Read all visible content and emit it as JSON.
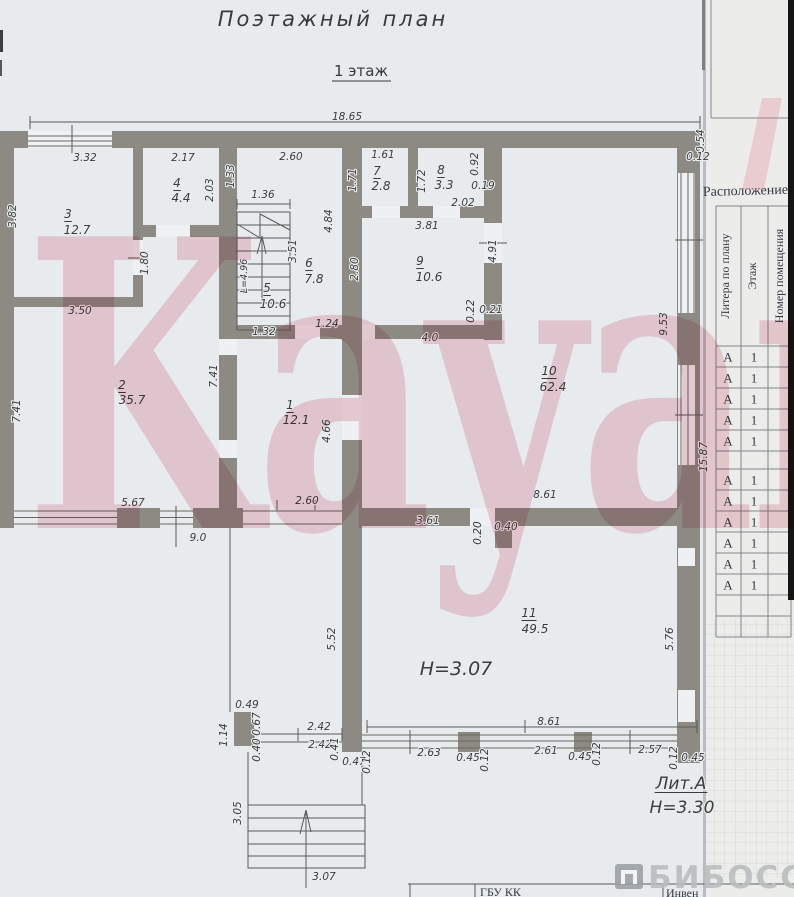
{
  "page": {
    "title": "Поэтажный план",
    "floor": "1 этаж"
  },
  "watermark": {
    "text": "Kayan",
    "brand": "БИБОСС"
  },
  "plan": {
    "rooms": [
      {
        "number": "1",
        "area_m2": "12.1"
      },
      {
        "number": "2",
        "area_m2": "35.7"
      },
      {
        "number": "3",
        "area_m2": "12.7"
      },
      {
        "number": "4",
        "area_m2": "4.4"
      },
      {
        "number": "5",
        "area_m2": "10.6"
      },
      {
        "number": "6",
        "area_m2": "7.8"
      },
      {
        "number": "7",
        "area_m2": "2.8"
      },
      {
        "number": "8",
        "area_m2": "3.3"
      },
      {
        "number": "9",
        "area_m2": "10.6"
      },
      {
        "number": "10",
        "area_m2": "62.4"
      },
      {
        "number": "11",
        "area_m2": "49.5"
      }
    ],
    "height_note_room11": "Н=3.07",
    "litera_note": "Лит.А",
    "height_note_building": "Н=3.30",
    "labels": [
      {
        "t": "18.65",
        "x": 347,
        "y": 120
      },
      {
        "t": "3.32",
        "x": 85,
        "y": 161
      },
      {
        "t": "2.17",
        "x": 183,
        "y": 161
      },
      {
        "t": "2.60",
        "x": 291,
        "y": 160
      },
      {
        "t": "1.61",
        "x": 383,
        "y": 158
      },
      {
        "t": "0.54",
        "x": 704,
        "y": 141,
        "r": -90
      },
      {
        "t": "0.12",
        "x": 698,
        "y": 160
      },
      {
        "t": "1.33",
        "x": 234,
        "y": 176,
        "r": -90
      },
      {
        "t": "1.71",
        "x": 356,
        "y": 180,
        "r": -90
      },
      {
        "t": "1.72",
        "x": 425,
        "y": 181,
        "r": -90
      },
      {
        "t": "0.92",
        "x": 478,
        "y": 164,
        "r": -90
      },
      {
        "t": "4",
        "x": 177,
        "y": 187,
        "s": 12,
        "u": true,
        "n": "room-number"
      },
      {
        "t": "4.4",
        "x": 181,
        "y": 202,
        "s": 12,
        "n": "room-area"
      },
      {
        "t": "2.03",
        "x": 213,
        "y": 190,
        "r": -90
      },
      {
        "t": "7",
        "x": 377,
        "y": 175,
        "s": 12,
        "u": true,
        "n": "room-number"
      },
      {
        "t": "2.8",
        "x": 381,
        "y": 190,
        "s": 12,
        "n": "room-area"
      },
      {
        "t": "8",
        "x": 441,
        "y": 174,
        "s": 12,
        "u": true,
        "n": "room-number"
      },
      {
        "t": "3.3",
        "x": 444,
        "y": 189,
        "s": 12,
        "n": "room-area"
      },
      {
        "t": "0.19",
        "x": 483,
        "y": 189
      },
      {
        "t": "2.02",
        "x": 463,
        "y": 206
      },
      {
        "t": "3",
        "x": 68,
        "y": 218,
        "s": 12,
        "u": true,
        "n": "room-number"
      },
      {
        "t": "12.7",
        "x": 77,
        "y": 234,
        "s": 12,
        "n": "room-area"
      },
      {
        "t": "3.82",
        "x": 16,
        "y": 216,
        "r": -90
      },
      {
        "t": "1.36",
        "x": 263,
        "y": 198
      },
      {
        "t": "4.84",
        "x": 332,
        "y": 221,
        "r": -90
      },
      {
        "t": "3.51",
        "x": 296,
        "y": 251,
        "r": -90
      },
      {
        "t": "3.81",
        "x": 427,
        "y": 229
      },
      {
        "t": "L=4.96",
        "x": 247,
        "y": 276,
        "r": -90,
        "s": 9.5
      },
      {
        "t": "6",
        "x": 309,
        "y": 267,
        "s": 12,
        "u": true,
        "n": "room-number"
      },
      {
        "t": "7.8",
        "x": 314,
        "y": 283,
        "s": 12,
        "n": "room-area"
      },
      {
        "t": "9",
        "x": 420,
        "y": 265,
        "s": 12,
        "u": true,
        "n": "room-number"
      },
      {
        "t": "10.6",
        "x": 429,
        "y": 281,
        "s": 12,
        "n": "room-area"
      },
      {
        "t": "2.80",
        "x": 358,
        "y": 269,
        "r": -90
      },
      {
        "t": "4.91",
        "x": 496,
        "y": 251,
        "r": -90
      },
      {
        "t": "1.80",
        "x": 148,
        "y": 263,
        "r": -90
      },
      {
        "t": "3.50",
        "x": 80,
        "y": 314
      },
      {
        "t": "5",
        "x": 267,
        "y": 292,
        "s": 12,
        "u": true,
        "n": "room-number"
      },
      {
        "t": "10.6",
        "x": 273,
        "y": 308,
        "s": 12,
        "n": "room-area"
      },
      {
        "t": "1.32",
        "x": 264,
        "y": 335
      },
      {
        "t": "1.24",
        "x": 327,
        "y": 327
      },
      {
        "t": "0.22",
        "x": 474,
        "y": 311,
        "r": -90
      },
      {
        "t": "0.21",
        "x": 491,
        "y": 313
      },
      {
        "t": "4.0",
        "x": 430,
        "y": 341
      },
      {
        "t": "9.53",
        "x": 667,
        "y": 324,
        "r": -90
      },
      {
        "t": "2",
        "x": 122,
        "y": 389,
        "s": 12,
        "u": true,
        "n": "room-number"
      },
      {
        "t": "35.7",
        "x": 132,
        "y": 404,
        "s": 12,
        "n": "room-area"
      },
      {
        "t": "7.41",
        "x": 20,
        "y": 411,
        "r": -90
      },
      {
        "t": "7.41",
        "x": 217,
        "y": 376,
        "r": -90
      },
      {
        "t": "1",
        "x": 290,
        "y": 409,
        "s": 12,
        "u": true,
        "n": "room-number"
      },
      {
        "t": "12.1",
        "x": 296,
        "y": 424,
        "s": 12,
        "n": "room-area"
      },
      {
        "t": "10",
        "x": 549,
        "y": 375,
        "s": 12,
        "u": true,
        "n": "room-number"
      },
      {
        "t": "62.4",
        "x": 553,
        "y": 391,
        "s": 12,
        "n": "room-area"
      },
      {
        "t": "4.66",
        "x": 330,
        "y": 431,
        "r": -90
      },
      {
        "t": "15.87",
        "x": 707,
        "y": 457,
        "r": -90
      },
      {
        "t": "8.61",
        "x": 545,
        "y": 498
      },
      {
        "t": "5.67",
        "x": 133,
        "y": 506
      },
      {
        "t": "2.60",
        "x": 307,
        "y": 504
      },
      {
        "t": "9.0",
        "x": 198,
        "y": 541
      },
      {
        "t": "3.61",
        "x": 428,
        "y": 524
      },
      {
        "t": "0.20",
        "x": 481,
        "y": 533,
        "r": -90
      },
      {
        "t": "0.40",
        "x": 506,
        "y": 530
      },
      {
        "t": "11",
        "x": 529,
        "y": 617,
        "s": 12,
        "u": true,
        "n": "room-number"
      },
      {
        "t": "49.5",
        "x": 535,
        "y": 633,
        "s": 12,
        "n": "room-area"
      },
      {
        "t": "5.52",
        "x": 335,
        "y": 639,
        "r": -90
      },
      {
        "t": "5.76",
        "x": 673,
        "y": 639,
        "r": -90
      },
      {
        "t": "Н=3.07",
        "x": 456,
        "y": 675,
        "s": 19,
        "n": "height-note-room11"
      },
      {
        "t": "0.49",
        "x": 247,
        "y": 708
      },
      {
        "t": "1.14",
        "x": 227,
        "y": 735,
        "r": -90
      },
      {
        "t": "0.67",
        "x": 260,
        "y": 724,
        "r": -90
      },
      {
        "t": "0.40",
        "x": 260,
        "y": 750,
        "r": -90
      },
      {
        "t": "2.42",
        "x": 319,
        "y": 730
      },
      {
        "t": "2.42",
        "x": 320,
        "y": 748
      },
      {
        "t": "0.41",
        "x": 338,
        "y": 749,
        "r": -90
      },
      {
        "t": "0.47",
        "x": 354,
        "y": 765
      },
      {
        "t": "0.12",
        "x": 370,
        "y": 762,
        "r": -90
      },
      {
        "t": "2.63",
        "x": 429,
        "y": 756
      },
      {
        "t": "0.45",
        "x": 468,
        "y": 761
      },
      {
        "t": "0.12",
        "x": 488,
        "y": 760,
        "r": -90
      },
      {
        "t": "8.61",
        "x": 549,
        "y": 725
      },
      {
        "t": "2.61",
        "x": 546,
        "y": 754
      },
      {
        "t": "0.45",
        "x": 580,
        "y": 760
      },
      {
        "t": "0.12",
        "x": 600,
        "y": 754,
        "r": -90
      },
      {
        "t": "2.57",
        "x": 650,
        "y": 753
      },
      {
        "t": "0.12",
        "x": 677,
        "y": 758,
        "r": -90
      },
      {
        "t": "0.45",
        "x": 693,
        "y": 761
      },
      {
        "t": "3.05",
        "x": 241,
        "y": 813,
        "r": -90
      },
      {
        "t": "3.07",
        "x": 324,
        "y": 880
      },
      {
        "t": "Лит.А",
        "x": 681,
        "y": 789,
        "s": 17,
        "u": true,
        "n": "litera-note"
      },
      {
        "t": "Н=3.30",
        "x": 682,
        "y": 813,
        "s": 17,
        "n": "height-note-building"
      }
    ]
  },
  "side_panel": {
    "heading": "Расположение",
    "columns": [
      "Литера по плану",
      "Этаж",
      "Номер помещения"
    ],
    "rows": [
      {
        "litera": "А",
        "floor": "1"
      },
      {
        "litera": "А",
        "floor": "1"
      },
      {
        "litera": "А",
        "floor": "1"
      },
      {
        "litera": "А",
        "floor": "1"
      },
      {
        "litera": "А",
        "floor": "1"
      },
      {
        "litera": "А",
        "floor": "1"
      },
      {
        "litera": "А",
        "floor": "1"
      },
      {
        "litera": "А",
        "floor": "1"
      },
      {
        "litera": "А",
        "floor": "1"
      },
      {
        "litera": "А",
        "floor": "1"
      },
      {
        "litera": "А",
        "floor": "1"
      }
    ]
  },
  "footer": {
    "org": "ГБУ КК",
    "doc": "Инвен"
  },
  "colors": {
    "wall": "#8d8a84",
    "paper": "#e8ebee",
    "watermark_pink": "#e28294",
    "brand_gray": "#b9bcbe",
    "grid_paper": "#ecedea"
  }
}
